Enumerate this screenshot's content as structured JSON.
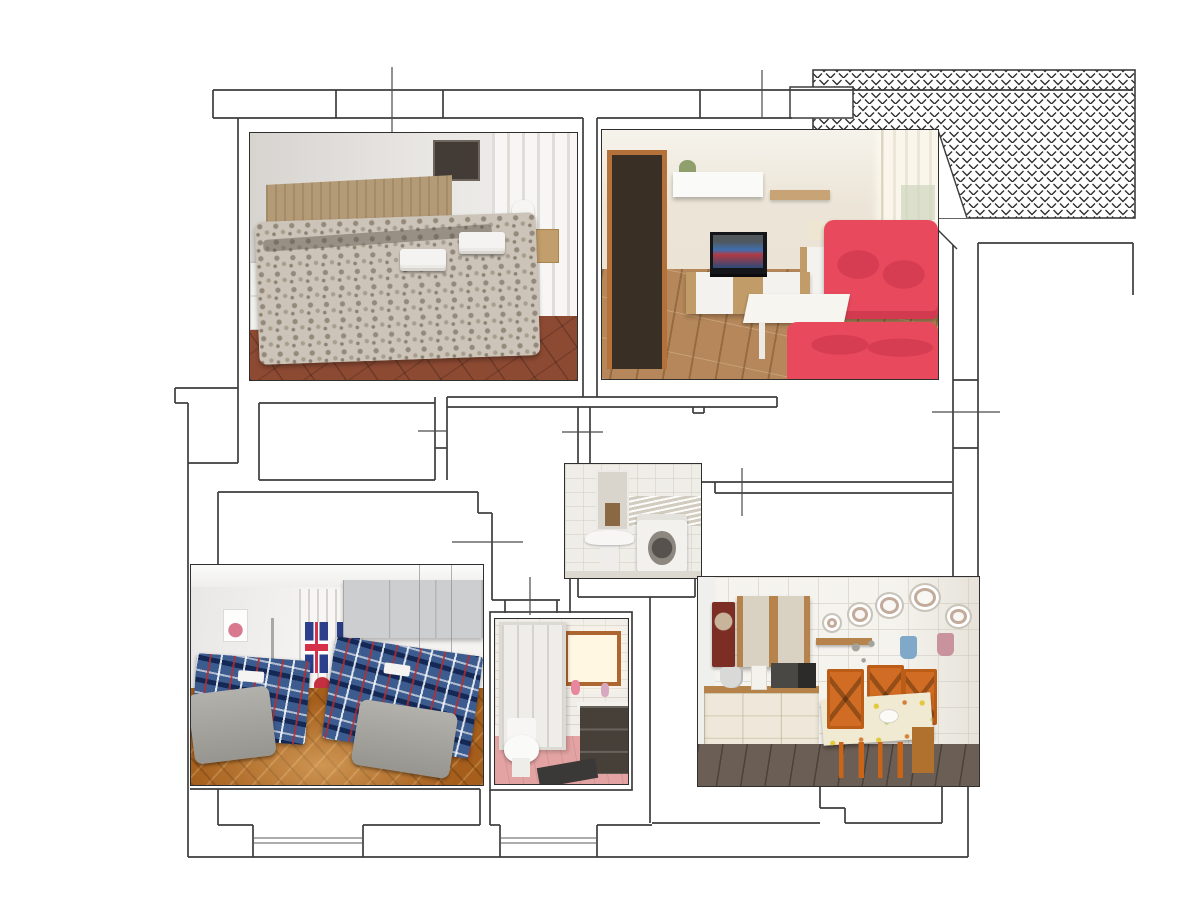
{
  "page": {
    "title": "Apartment floor plan collage with six room photos",
    "background": "#ffffff"
  },
  "floor_plan": {
    "line_color": "#3d3d3d",
    "terrace": {
      "label": "hatched terrace area",
      "pattern": "diamond chevron hatch",
      "position": "top-right"
    },
    "symbols": {
      "windows": "double parallel lines in bottom exterior wall",
      "doors": "short tick marks crossing walls at openings"
    }
  },
  "photos": [
    {
      "id": "double-bedroom",
      "title": "Double bedroom - wooden headboard, grey damask bedspread, two towel stacks, white and wood nightstands, sheer curtained window, terracotta tile floor",
      "colors": {
        "floor": "#8d4a33",
        "headboard": "#b49b77",
        "bedspread": "#cdc5b9"
      }
    },
    {
      "id": "living-room",
      "title": "Living room - red sofa bed and second red sofa, TV on wood lowboard, white wall cabinet, white coffee table, wood plank floor, dark doorway",
      "colors": {
        "sofa": "#e8495c",
        "floor": "#b5875a",
        "wall": "#ece5d7"
      }
    },
    {
      "id": "bathroom-laundry",
      "title": "Bathroom - mirror, pedestal sink and white washing machine against cream tiles",
      "colors": {
        "tiles": "#efede8",
        "washer_door": "#57524d"
      }
    },
    {
      "id": "twin-bedroom",
      "title": "Twin bedroom - two single beds with blue tartan covers, grey wardrobe and bridge cabinets, Union Jack curtains, parquet floor",
      "colors": {
        "plaid": "#3c5c90",
        "wardrobe": "#c6c7c9",
        "floor": "#a55e1b"
      }
    },
    {
      "id": "shower-room",
      "title": "Shower room - folding-door shower cabin, toilet, dark vanity with sink, bright wood-framed window, pink floor, dark mat",
      "colors": {
        "floor": "#e3a3a2",
        "window_frame": "#ae6630",
        "vanity": "#474039"
      }
    },
    {
      "id": "kitchen",
      "title": "Kitchen dining room - cream base cabinets with wood top, wood glass wall cabinet, cuckoo clock, decorative plates, dining table with orange chairs",
      "colors": {
        "cabinets": "#efe8da",
        "chairs": "#cf6a1f",
        "wood": "#b5834b",
        "floor": "#6b5e55"
      }
    }
  ]
}
